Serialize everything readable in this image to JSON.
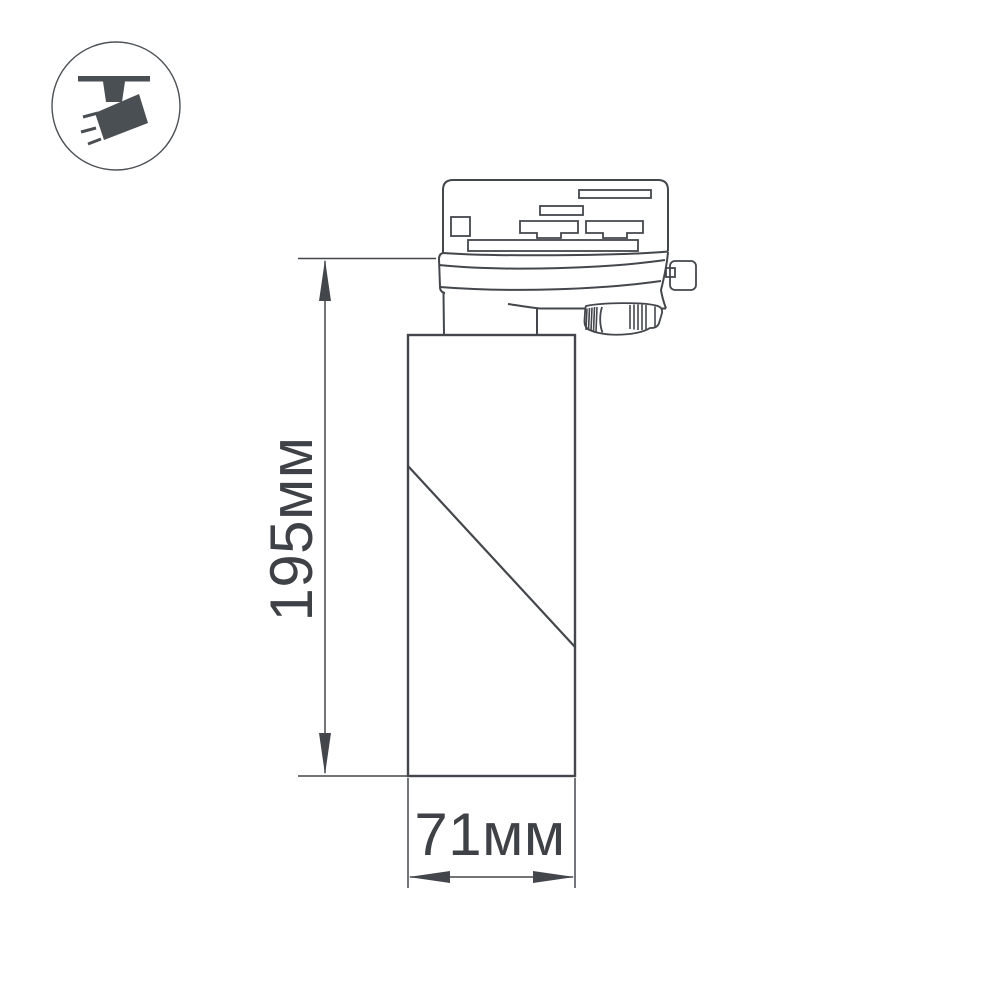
{
  "badge": {
    "icon": "ceiling-track-spotlight-icon",
    "icon_color": "#4a4f54",
    "ring_color": "#4d5257"
  },
  "drawing": {
    "stroke_color": "#43474c",
    "label_color": "#3e4247",
    "dimensions": {
      "height": {
        "label": "195мм",
        "value": 195,
        "unit": "мм",
        "orientation": "vertical"
      },
      "width": {
        "label": "71мм",
        "value": 71,
        "unit": "мм",
        "orientation": "horizontal"
      }
    }
  }
}
